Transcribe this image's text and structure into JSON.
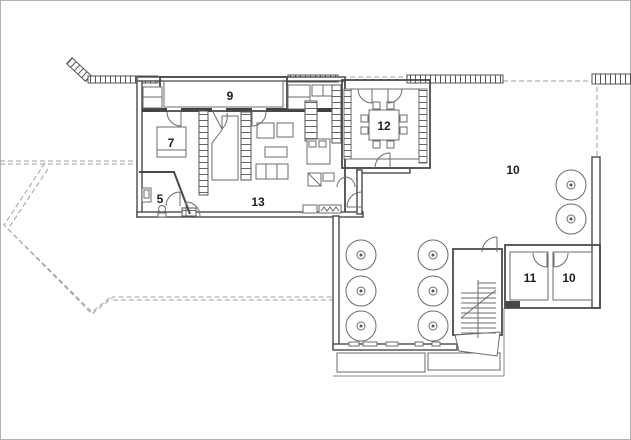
{
  "page": {
    "type": "architectural floor plan drawing",
    "background": "#ffffff",
    "frame_color": "#b3b3b3"
  },
  "plan": {
    "rooms": [
      {
        "id": "porch",
        "label": "9"
      },
      {
        "id": "bedroom",
        "label": "7"
      },
      {
        "id": "wc",
        "label": "5"
      },
      {
        "id": "living-room",
        "label": "13"
      },
      {
        "id": "dining-room",
        "label": "12"
      },
      {
        "id": "terrace",
        "label": "10"
      },
      {
        "id": "store-1",
        "label": "11"
      },
      {
        "id": "store-2",
        "label": "10"
      }
    ],
    "colors": {
      "wall": "#4a4a4a",
      "thin_line": "#6b6b6b",
      "dashed_boundary": "#9f9f9f",
      "label": "#1d1d1d"
    },
    "features": [
      "hatched-site-wall",
      "dashed-property-line",
      "dining-table-8-chairs",
      "round-terrace-tables-x8",
      "switchback-staircase",
      "bed",
      "sofa-set",
      "planters",
      "door-arcs"
    ]
  }
}
